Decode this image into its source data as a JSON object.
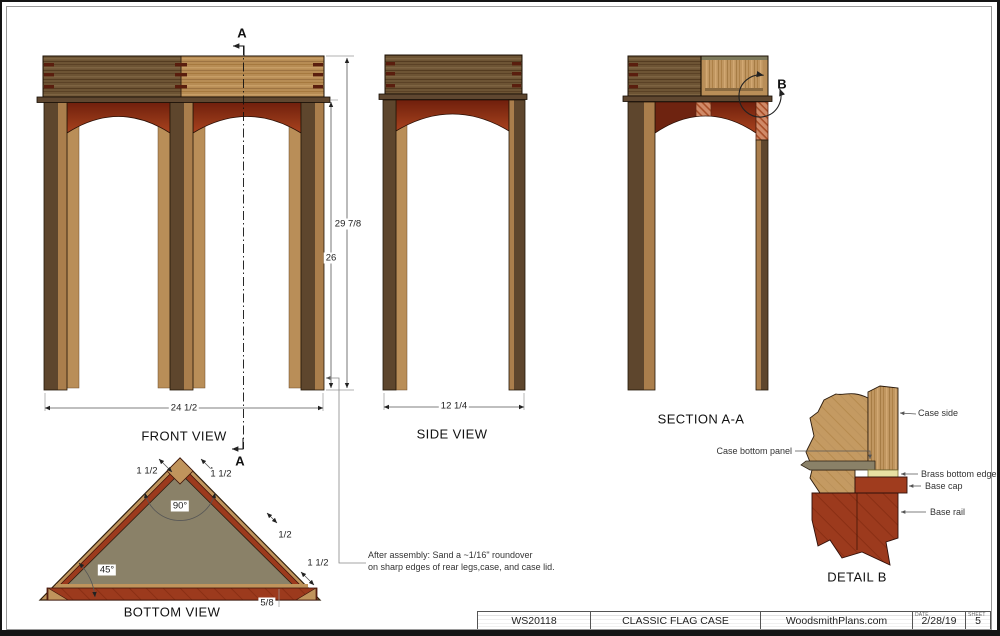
{
  "sheet": {
    "views": {
      "front": "FRONT VIEW",
      "side": "SIDE VIEW",
      "section": "SECTION A-A",
      "bottom": "BOTTOM VIEW",
      "detail": "DETAIL  B"
    },
    "marks": {
      "a": "A",
      "b": "B"
    },
    "dims": {
      "total_height": "29 7/8",
      "leg_height": "26",
      "front_width": "24 1/2",
      "side_width": "12 1/4",
      "corner_block": "1 1/2",
      "apex_angle": "90°",
      "corner_angle": "45°",
      "rail_thickness": "1/2",
      "rear_corner_block": "1 1/2",
      "base_offset": "5/8"
    },
    "note": {
      "line1": "After assembly: Sand a ~1/16\" roundover",
      "line2": "on sharp edges of rear legs,case, and case lid."
    },
    "detail_labels": {
      "case_side": "Case side",
      "case_bottom_panel": "Case bottom panel",
      "brass_bottom_edge": "Brass bottom edge",
      "base_cap": "Base cap",
      "base_rail": "Base rail"
    },
    "title_block": {
      "plan_number": "WS20118",
      "title": "CLASSIC FLAG CASE",
      "website": "WoodsmithPlans.com",
      "date_label": "DATE",
      "date": "2/28/19",
      "sheet_label": "SHEET",
      "sheet_number": "5"
    },
    "colors": {
      "wood_light": "#b78c54",
      "wood_dark": "#6d5434",
      "leg_dark": "#5e462d",
      "leg_light": "#aa7e4c",
      "apron_red": "#9c3a1d",
      "apron_dark": "#701f0c",
      "panel_gray": "#8a8168",
      "brass": "#e8e0a2",
      "dovetail_mark": "#5a1e0e"
    }
  }
}
